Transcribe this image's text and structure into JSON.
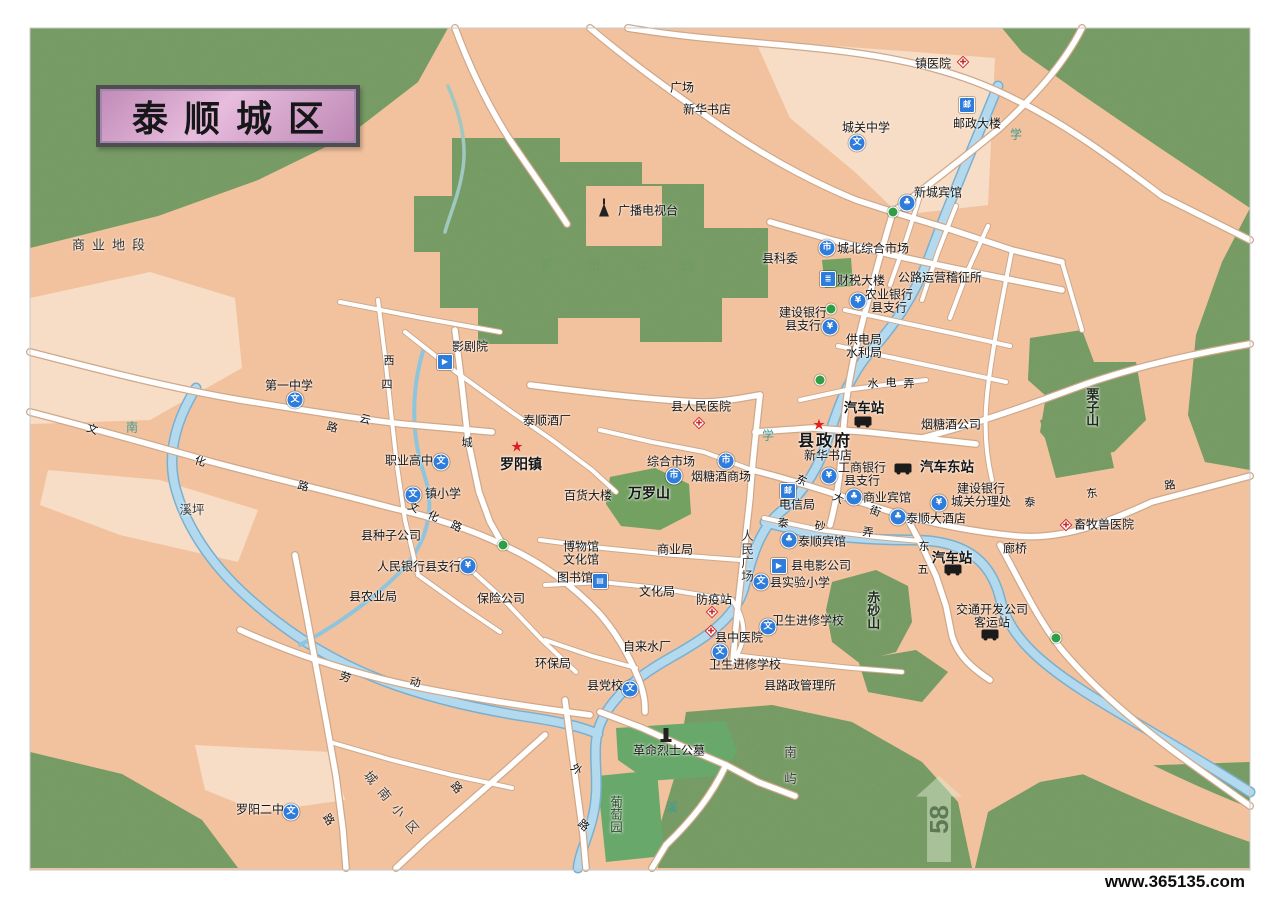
{
  "title": {
    "text": "泰顺城区"
  },
  "page_marker": {
    "number": "58"
  },
  "footer": {
    "watermark": "www.365135.com"
  },
  "colors": {
    "urban": "#f2c29e",
    "urban_light": "#f7ddc6",
    "green": "#8bac74",
    "green_dark": "#69a86b",
    "river": "#b3d9ee",
    "road": "#ffffff",
    "road_casing": "#cfa88a",
    "title_pink": "#d9a8cf",
    "icon_blue": "#2e7ddd",
    "star_red": "#e02020"
  },
  "icon_glyphs": {
    "school": "文",
    "bank": "¥",
    "market": "市",
    "post": "邮",
    "hotel": "♣",
    "cinema": "▶",
    "bank-bld": "≣",
    "library": "▤",
    "star": "★"
  },
  "map": {
    "labels": [
      {
        "n": "zhen-yiyuan",
        "t": "镇医院",
        "x": 933,
        "y": 64,
        "icon": "hospital",
        "ix": 30,
        "iy": -2
      },
      {
        "n": "guangchang",
        "t": "广场",
        "x": 682,
        "y": 88
      },
      {
        "n": "xinhua-shudian-north",
        "t": "新华书店",
        "x": 707,
        "y": 110
      },
      {
        "n": "chengguan-zhongxue",
        "t": "城关中学",
        "x": 866,
        "y": 128,
        "icon": "school",
        "ix": -9,
        "iy": 15
      },
      {
        "n": "youzheng-dalou",
        "t": "邮政大楼",
        "x": 977,
        "y": 124,
        "icon": "post",
        "ix": -10,
        "iy": -19
      },
      {
        "n": "xincheng-binguan",
        "t": "新城宾馆",
        "x": 938,
        "y": 193,
        "icon": "hotel",
        "ix": -31,
        "iy": 10
      },
      {
        "n": "guangbo-dianshitai",
        "t": "广播电视台",
        "x": 648,
        "y": 211,
        "icon": "tower",
        "ix": -44,
        "iy": -1
      },
      {
        "n": "xian-kewei",
        "t": "县科委",
        "x": 780,
        "y": 259
      },
      {
        "n": "chengbei-zonghe-shichang",
        "t": "城北综合市场",
        "x": 873,
        "y": 249,
        "icon": "market",
        "ix": -46,
        "iy": -1
      },
      {
        "n": "gonglu-yunying-jizhengsuo",
        "t": "公路运营稽征所",
        "x": 940,
        "y": 278
      },
      {
        "n": "caishui-dalou",
        "t": "财税大楼",
        "x": 861,
        "y": 281,
        "icon": "bank-bld",
        "ix": -33,
        "iy": -2
      },
      {
        "n": "nongye-yinhang-zhihang",
        "t": "农业银行\n县支行",
        "x": 889,
        "y": 302,
        "icon": "bank",
        "ix": -31,
        "iy": -1
      },
      {
        "n": "jianshe-yinhang-xianzhihang",
        "t": "建设银行\n县支行",
        "x": 803,
        "y": 320,
        "icon": "bank",
        "ix": 27,
        "iy": 7
      },
      {
        "n": "gongdianju-shuiliju",
        "t": "供电局\n水利局",
        "x": 864,
        "y": 347
      },
      {
        "n": "qichezhan-north",
        "t": "汽车站",
        "x": 864,
        "y": 408,
        "k": "strong",
        "icon": "bus",
        "ix": -1,
        "iy": 13
      },
      {
        "n": "xianzhengfu",
        "t": "县政府",
        "x": 825,
        "y": 442,
        "k": "gov",
        "icon": "star",
        "ix": -6,
        "iy": -17
      },
      {
        "n": "xinhua-shudian-south",
        "t": "新华书店",
        "x": 828,
        "y": 456
      },
      {
        "n": "yantangjiu-gongsi",
        "t": "烟糖酒公司",
        "x": 951,
        "y": 425
      },
      {
        "n": "qiche-dongzhan",
        "t": "汽车东站",
        "x": 947,
        "y": 467,
        "k": "strong",
        "icon": "bus",
        "ix": -44,
        "iy": 1
      },
      {
        "n": "gongshang-yinhang",
        "t": "工商银行\n县支行",
        "x": 862,
        "y": 475,
        "icon": "bank",
        "ix": -33,
        "iy": 1
      },
      {
        "n": "jianshe-yinhang-chengguan",
        "t": "建设银行\n城关分理处",
        "x": 981,
        "y": 496,
        "icon": "bank",
        "ix": -42,
        "iy": 7
      },
      {
        "n": "shangye-binguan",
        "t": "商业宾馆",
        "x": 887,
        "y": 498,
        "icon": "hotel",
        "ix": -33,
        "iy": -1
      },
      {
        "n": "dianxinju",
        "t": "电信局",
        "x": 797,
        "y": 505,
        "icon": "post",
        "ix": -9,
        "iy": -14
      },
      {
        "n": "taishun-dajiudian",
        "t": "泰顺大酒店",
        "x": 936,
        "y": 519,
        "icon": "hotel",
        "ix": -38,
        "iy": -2
      },
      {
        "n": "langqiao",
        "t": "廊桥",
        "x": 1015,
        "y": 549
      },
      {
        "n": "xumu-shouyi-yuan",
        "t": "畜牧兽医院",
        "x": 1104,
        "y": 525,
        "icon": "hospital",
        "ix": -38,
        "iy": 0
      },
      {
        "n": "qichezhan-se",
        "t": "汽车站",
        "x": 952,
        "y": 558,
        "k": "strong",
        "icon": "bus",
        "ix": 1,
        "iy": 11
      },
      {
        "n": "jiaotong-kaifa-keyunzhan",
        "t": "交通开发公司\n客运站",
        "x": 992,
        "y": 617,
        "icon": "bus",
        "ix": -2,
        "iy": 17
      },
      {
        "n": "taishun-binguan",
        "t": "泰顺宾馆",
        "x": 822,
        "y": 542,
        "icon": "hotel",
        "ix": -33,
        "iy": -2
      },
      {
        "n": "xian-dianying-gongsi",
        "t": "县电影公司",
        "x": 821,
        "y": 566,
        "icon": "cinema",
        "ix": -42,
        "iy": 0
      },
      {
        "n": "xian-shiyan-xiaoxue",
        "t": "县实验小学",
        "x": 800,
        "y": 583,
        "icon": "school",
        "ix": -39,
        "iy": -1
      },
      {
        "n": "weisheng-jinxiu-xuexiao-1",
        "t": "卫生进修学校",
        "x": 808,
        "y": 621,
        "icon": "school",
        "ix": -40,
        "iy": 6
      },
      {
        "n": "xian-zhongyiyuan",
        "t": "县中医院",
        "x": 739,
        "y": 638,
        "icon": "hospital",
        "ix": -28,
        "iy": -7
      },
      {
        "n": "weisheng-jinxiu-xuexiao-2",
        "t": "卫生进修学校",
        "x": 745,
        "y": 665,
        "icon": "school",
        "ix": -25,
        "iy": -13
      },
      {
        "n": "fangyizhan",
        "t": "防疫站",
        "x": 714,
        "y": 600,
        "icon": "hospital",
        "ix": -2,
        "iy": 12
      },
      {
        "n": "wenhuaju",
        "t": "文化局",
        "x": 657,
        "y": 592
      },
      {
        "n": "shangyeju",
        "t": "商业局",
        "x": 675,
        "y": 550
      },
      {
        "n": "bowuguan-wenhuaguan",
        "t": "博物馆\n文化馆",
        "x": 581,
        "y": 554
      },
      {
        "n": "tushuguan",
        "t": "图书馆",
        "x": 575,
        "y": 578,
        "icon": "library",
        "ix": 25,
        "iy": 3
      },
      {
        "n": "baoxian-gongsi",
        "t": "保险公司",
        "x": 501,
        "y": 599
      },
      {
        "n": "renmin-yinhang",
        "t": "人民银行县支行",
        "x": 419,
        "y": 567,
        "icon": "bank",
        "ix": 49,
        "iy": -1
      },
      {
        "n": "xian-nongyeju",
        "t": "县农业局",
        "x": 373,
        "y": 597
      },
      {
        "n": "xian-zhongzi-gongsi",
        "t": "县种子公司",
        "x": 391,
        "y": 536
      },
      {
        "n": "xiping",
        "t": "溪坪",
        "x": 192,
        "y": 510,
        "k": "area"
      },
      {
        "n": "huanbaoju",
        "t": "环保局",
        "x": 553,
        "y": 664
      },
      {
        "n": "zilaishuichang",
        "t": "自来水厂",
        "x": 647,
        "y": 647
      },
      {
        "n": "xian-dangxiao",
        "t": "县党校",
        "x": 605,
        "y": 686,
        "icon": "school",
        "ix": 25,
        "iy": 3
      },
      {
        "n": "xian-luzheng-guanlisuo",
        "t": "县路政管理所",
        "x": 800,
        "y": 686
      },
      {
        "n": "geming-lieshi-gongmu",
        "t": "革命烈士公墓",
        "x": 669,
        "y": 751,
        "icon": "monument",
        "ix": -3,
        "iy": -17
      },
      {
        "n": "putaoyuan",
        "t": "葡萄园",
        "x": 615,
        "y": 814,
        "k": "area-green",
        "v": true
      },
      {
        "n": "luoyang-erzhong",
        "t": "罗阳二中",
        "x": 260,
        "y": 810,
        "icon": "school",
        "ix": 31,
        "iy": 2
      },
      {
        "n": "chengnan-xiaoqu",
        "t": "城南小区",
        "x": 394,
        "y": 806,
        "k": "area",
        "rot": 50,
        "ls": 9
      },
      {
        "n": "chishashan",
        "t": "赤砂山",
        "x": 872,
        "y": 610,
        "k": "hill",
        "v": true
      },
      {
        "n": "lizishan",
        "t": "栗子山",
        "x": 1091,
        "y": 407,
        "k": "hill",
        "v": true
      },
      {
        "n": "wanluoshan",
        "t": "万罗山",
        "x": 649,
        "y": 494,
        "k": "hill-bold"
      },
      {
        "n": "baihuo-dalou",
        "t": "百货大楼",
        "x": 588,
        "y": 496
      },
      {
        "n": "zonghe-shichang",
        "t": "综合市场",
        "x": 671,
        "y": 462,
        "icon": "market",
        "ix": 3,
        "iy": 14
      },
      {
        "n": "yantangjiu-shangchang",
        "t": "烟糖酒商场",
        "x": 721,
        "y": 477,
        "icon": "market",
        "ix": 5,
        "iy": -16
      },
      {
        "n": "xian-renmin-yiyuan",
        "t": "县人民医院",
        "x": 701,
        "y": 407,
        "icon": "hospital",
        "ix": -2,
        "iy": 16
      },
      {
        "n": "diyi-zhongxue",
        "t": "第一中学",
        "x": 289,
        "y": 386,
        "icon": "school",
        "ix": 6,
        "iy": 14
      },
      {
        "n": "yingjuyuan",
        "t": "影剧院",
        "x": 470,
        "y": 347,
        "icon": "cinema",
        "ix": -25,
        "iy": 15
      },
      {
        "n": "taishun-jiuchang",
        "t": "泰顺酒厂",
        "x": 547,
        "y": 421
      },
      {
        "n": "luoyangzhen",
        "t": "罗阳镇",
        "x": 521,
        "y": 465,
        "k": "town",
        "icon": "star",
        "ix": -4,
        "iy": -18
      },
      {
        "n": "zhiye-gaozhong",
        "t": "职业高中",
        "x": 409,
        "y": 461,
        "icon": "school",
        "ix": 32,
        "iy": 1
      },
      {
        "n": "zhen-xiaoxue",
        "t": "镇小学",
        "x": 443,
        "y": 494,
        "icon": "school",
        "ix": -30,
        "iy": 1
      },
      {
        "n": "shangye-diduan",
        "t": "商业地段",
        "x": 112,
        "y": 246,
        "k": "area-sp"
      },
      {
        "n": "luoyang-gongyuan",
        "t": "罗阳公园",
        "x": 634,
        "y": 266,
        "k": "park-faint",
        "ls": 34
      },
      {
        "n": "nanyu",
        "t": "南屿",
        "x": 789,
        "y": 772,
        "k": "area",
        "v": true,
        "ls": 14
      },
      {
        "n": "renmin-guangchang",
        "t": "人民广场",
        "x": 746,
        "y": 556,
        "k": "area",
        "v": true,
        "ls": 1
      },
      {
        "n": "road-wenhualu-1a",
        "t": "文",
        "x": 92,
        "y": 430,
        "k": "road",
        "rot": 18
      },
      {
        "n": "road-wenhualu-1b",
        "t": "化",
        "x": 200,
        "y": 462,
        "k": "road",
        "rot": 18
      },
      {
        "n": "road-wenhualu-1c",
        "t": "路",
        "x": 303,
        "y": 487,
        "k": "road",
        "rot": 14
      },
      {
        "n": "road-wenhualu-2a",
        "t": "文",
        "x": 413,
        "y": 508,
        "k": "road",
        "rot": 24
      },
      {
        "n": "road-wenhualu-2b",
        "t": "化",
        "x": 433,
        "y": 517,
        "k": "road",
        "rot": 24
      },
      {
        "n": "road-wenhualu-2c",
        "t": "路",
        "x": 456,
        "y": 527,
        "k": "road",
        "rot": 24
      },
      {
        "n": "road-dongdajie-a",
        "t": "东",
        "x": 801,
        "y": 481,
        "k": "road",
        "rot": 26
      },
      {
        "n": "road-dongdajie-b",
        "t": "大",
        "x": 838,
        "y": 499,
        "k": "road",
        "rot": 26
      },
      {
        "n": "road-dongdajie-c",
        "t": "街",
        "x": 875,
        "y": 512,
        "k": "road",
        "rot": 20
      },
      {
        "n": "road-shuidiannong-a",
        "t": "水",
        "x": 873,
        "y": 384,
        "k": "road"
      },
      {
        "n": "road-shuidiannong-b",
        "t": "电",
        "x": 891,
        "y": 383,
        "k": "road"
      },
      {
        "n": "road-shuidiannong-c",
        "t": "弄",
        "x": 909,
        "y": 384,
        "k": "road"
      },
      {
        "n": "road-taidonglu-a",
        "t": "泰",
        "x": 1030,
        "y": 503,
        "k": "road",
        "rot": -8
      },
      {
        "n": "road-taidonglu-b",
        "t": "东",
        "x": 1092,
        "y": 494,
        "k": "road",
        "rot": -8
      },
      {
        "n": "road-taidonglu-c",
        "t": "路",
        "x": 1170,
        "y": 486,
        "k": "road",
        "rot": -8
      },
      {
        "n": "road-taishanong-a",
        "t": "泰",
        "x": 783,
        "y": 524,
        "k": "road",
        "rot": 8
      },
      {
        "n": "road-taishanong-b",
        "t": "砂",
        "x": 820,
        "y": 527,
        "k": "road",
        "rot": 8
      },
      {
        "n": "road-taishanong-c",
        "t": "弄",
        "x": 868,
        "y": 533,
        "k": "road",
        "rot": 8
      },
      {
        "n": "road-dongwu-a",
        "t": "东",
        "x": 924,
        "y": 547,
        "k": "road"
      },
      {
        "n": "road-dongwu-b",
        "t": "五",
        "x": 923,
        "y": 570,
        "k": "road"
      },
      {
        "n": "road-laodonglu-a",
        "t": "劳",
        "x": 345,
        "y": 678,
        "k": "road",
        "rot": 20
      },
      {
        "n": "road-laodonglu-b",
        "t": "动",
        "x": 415,
        "y": 683,
        "k": "road",
        "rot": 10
      },
      {
        "n": "road-wailu-a",
        "t": "外",
        "x": 576,
        "y": 770,
        "k": "road",
        "rot": 40
      },
      {
        "n": "road-wailu-b",
        "t": "路",
        "x": 583,
        "y": 826,
        "k": "road",
        "rot": 40
      },
      {
        "n": "road-lu-sw",
        "t": "路",
        "x": 328,
        "y": 820,
        "k": "road",
        "rot": 55
      },
      {
        "n": "road-lu-se",
        "t": "路",
        "x": 456,
        "y": 788,
        "k": "road",
        "rot": 50
      },
      {
        "n": "road-cheng",
        "t": "城",
        "x": 467,
        "y": 443,
        "k": "road"
      },
      {
        "n": "road-xisi-a",
        "t": "西",
        "x": 389,
        "y": 361,
        "k": "road"
      },
      {
        "n": "road-xisi-b",
        "t": "四",
        "x": 387,
        "y": 385,
        "k": "road"
      },
      {
        "n": "road-yun",
        "t": "云",
        "x": 365,
        "y": 420,
        "k": "road",
        "rot": 15
      },
      {
        "n": "road-lu-nw",
        "t": "路",
        "x": 332,
        "y": 428,
        "k": "road",
        "rot": 15
      },
      {
        "n": "river-nan",
        "t": "南",
        "x": 132,
        "y": 428,
        "k": "river"
      },
      {
        "n": "river-xue-1",
        "t": "学",
        "x": 768,
        "y": 436,
        "k": "river"
      },
      {
        "n": "river-xue-2",
        "t": "学",
        "x": 1016,
        "y": 135,
        "k": "river"
      },
      {
        "n": "river-xi",
        "t": "溪",
        "x": 672,
        "y": 808,
        "k": "river"
      }
    ],
    "dots": [
      [
        893,
        212
      ],
      [
        831,
        309
      ],
      [
        820,
        380
      ],
      [
        503,
        545
      ],
      [
        1056,
        638
      ]
    ]
  }
}
